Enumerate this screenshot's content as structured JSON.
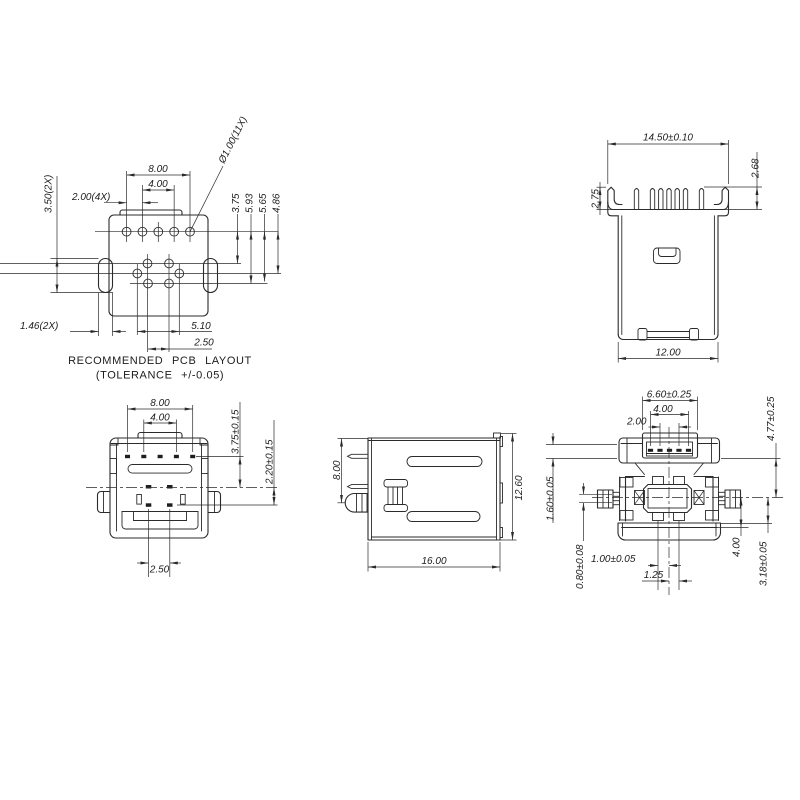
{
  "colors": {
    "background": "#ffffff",
    "line": "#2b2b2b",
    "text": "#1c1c1c"
  },
  "views": {
    "pcb_layout": {
      "caption_line1": "RECOMMENDED PCB LAYOUT",
      "caption_line2": "(TOLERANCE +/-0.05)",
      "dim_hole_span": "8.00",
      "dim_hole_inner_span": "4.00",
      "dim_hole_pitch": "2.00(4X)",
      "dim_slot_length": "3.50(2X)",
      "dim_slot_width": "1.46(2X)",
      "dim_hole_diameter": "Ø1.00(11X)",
      "dim_row_offset_1": "3.75",
      "dim_row_offset_2": "5.93",
      "dim_row_offset_3": "5.65",
      "dim_row_offset_4": "4.86",
      "dim_cluster_span": "5.10",
      "dim_cluster_inner": "2.50"
    },
    "plug_side_view": {
      "dim_overall_width": "14.50±0.10",
      "dim_flange_height": "2.75",
      "dim_contact_height": "2.68",
      "dim_body_width": "12.00"
    },
    "bottom_view": {
      "dim_pad_span": "8.00",
      "dim_pad_inner_span": "4.00",
      "dim_upper_offset": "3.75±0.15",
      "dim_lower_offset": "2.20±0.15",
      "dim_center_pad_span": "2.50"
    },
    "profile_view": {
      "dim_post_offset": "8.00",
      "dim_length": "16.00",
      "dim_height": "12.60"
    },
    "front_view": {
      "dim_opening_width": "6.60±0.25",
      "dim_contact_span": "4.00",
      "dim_contact_inner_span": "2.00",
      "dim_opening_offset": "4.77±0.25",
      "dim_flange_step": "1.60±0.05",
      "dim_lead_thickness": "0.80±0.08",
      "dim_lead_offset": "1.00±0.05",
      "dim_lead_pitch": "1.25",
      "dim_block_offset": "4.00",
      "dim_base_offset": "3.18±0.05"
    }
  }
}
